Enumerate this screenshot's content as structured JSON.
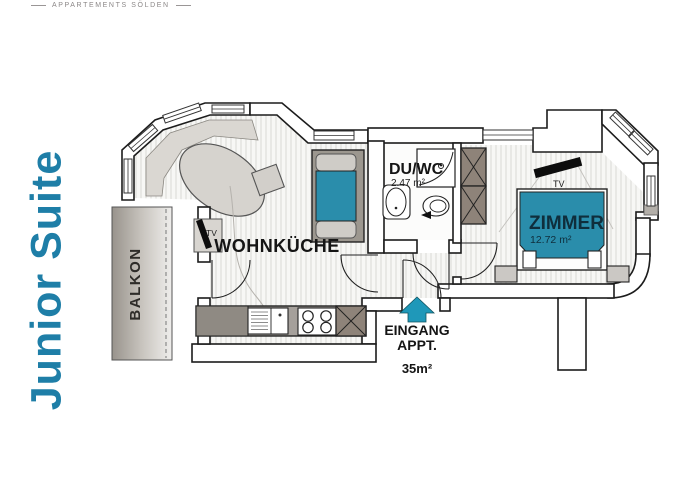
{
  "brand": {
    "logo_text": "APPARTEMENTS SÖLDEN"
  },
  "title": {
    "text": "Junior Suite"
  },
  "colors": {
    "accent_teal": "#1e7ea7",
    "arrow_teal": "#1f98b9",
    "furniture_blue": "#2a8dab",
    "wardrobe_taupe": "#8e8379",
    "bed_text": "#0f2e3c"
  },
  "rooms": {
    "wohnkueche": {
      "label": "WOHNKÜCHE"
    },
    "duwc": {
      "label": "DU/WC",
      "area": "2.47 m²"
    },
    "zimmer": {
      "label": "ZIMMER",
      "area": "12.72 m²"
    },
    "balkon": {
      "label": "BALKON"
    }
  },
  "labels": {
    "entrance_line1": "EINGANG",
    "entrance_line2": "APPT.",
    "total_area": "35m²",
    "tv_living": "TV",
    "tv_bedroom": "TV"
  }
}
